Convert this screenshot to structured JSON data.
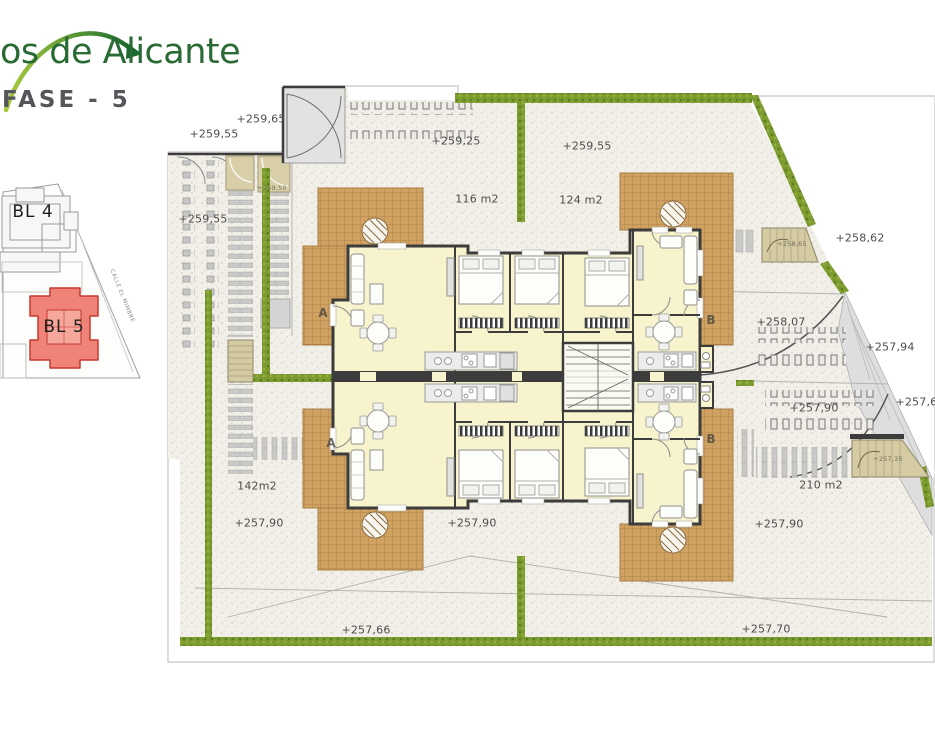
{
  "header": {
    "brand": "os de Alicante",
    "phase": "FASE - 5"
  },
  "site_plan": {
    "block_back": "BL 4",
    "block_current": "BL 5",
    "street": "CALLE EL MIMBRE",
    "highlight_color": "#ef8377"
  },
  "plan": {
    "units": [
      "A",
      "A",
      "B",
      "B"
    ],
    "labels": [
      {
        "text": "+259,65"
      },
      {
        "text": "+259,55"
      },
      {
        "text": "+259,25"
      },
      {
        "text": "+259,50"
      },
      {
        "text": "+259,55"
      },
      {
        "text": "116 m2"
      },
      {
        "text": "124 m2"
      },
      {
        "text": "+259,55"
      },
      {
        "text": "+258,65"
      },
      {
        "text": "+258,62"
      },
      {
        "text": "+258,07"
      },
      {
        "text": "+257,94"
      },
      {
        "text": "+257,90"
      },
      {
        "text": "+257,65"
      },
      {
        "text": "+257,35"
      },
      {
        "text": "210 m2"
      },
      {
        "text": "+257,90"
      },
      {
        "text": "142m2"
      },
      {
        "text": "+257,90"
      },
      {
        "text": "+257,90"
      },
      {
        "text": "+257,66"
      },
      {
        "text": "+257,70"
      }
    ],
    "colors": {
      "hedge_green": "#7d9c30",
      "terrace_tile": "#d0a262",
      "room_cream": "#f7f4cd",
      "wall_dark": "#3c3c3c",
      "logo_green": "#2a6b35"
    }
  }
}
